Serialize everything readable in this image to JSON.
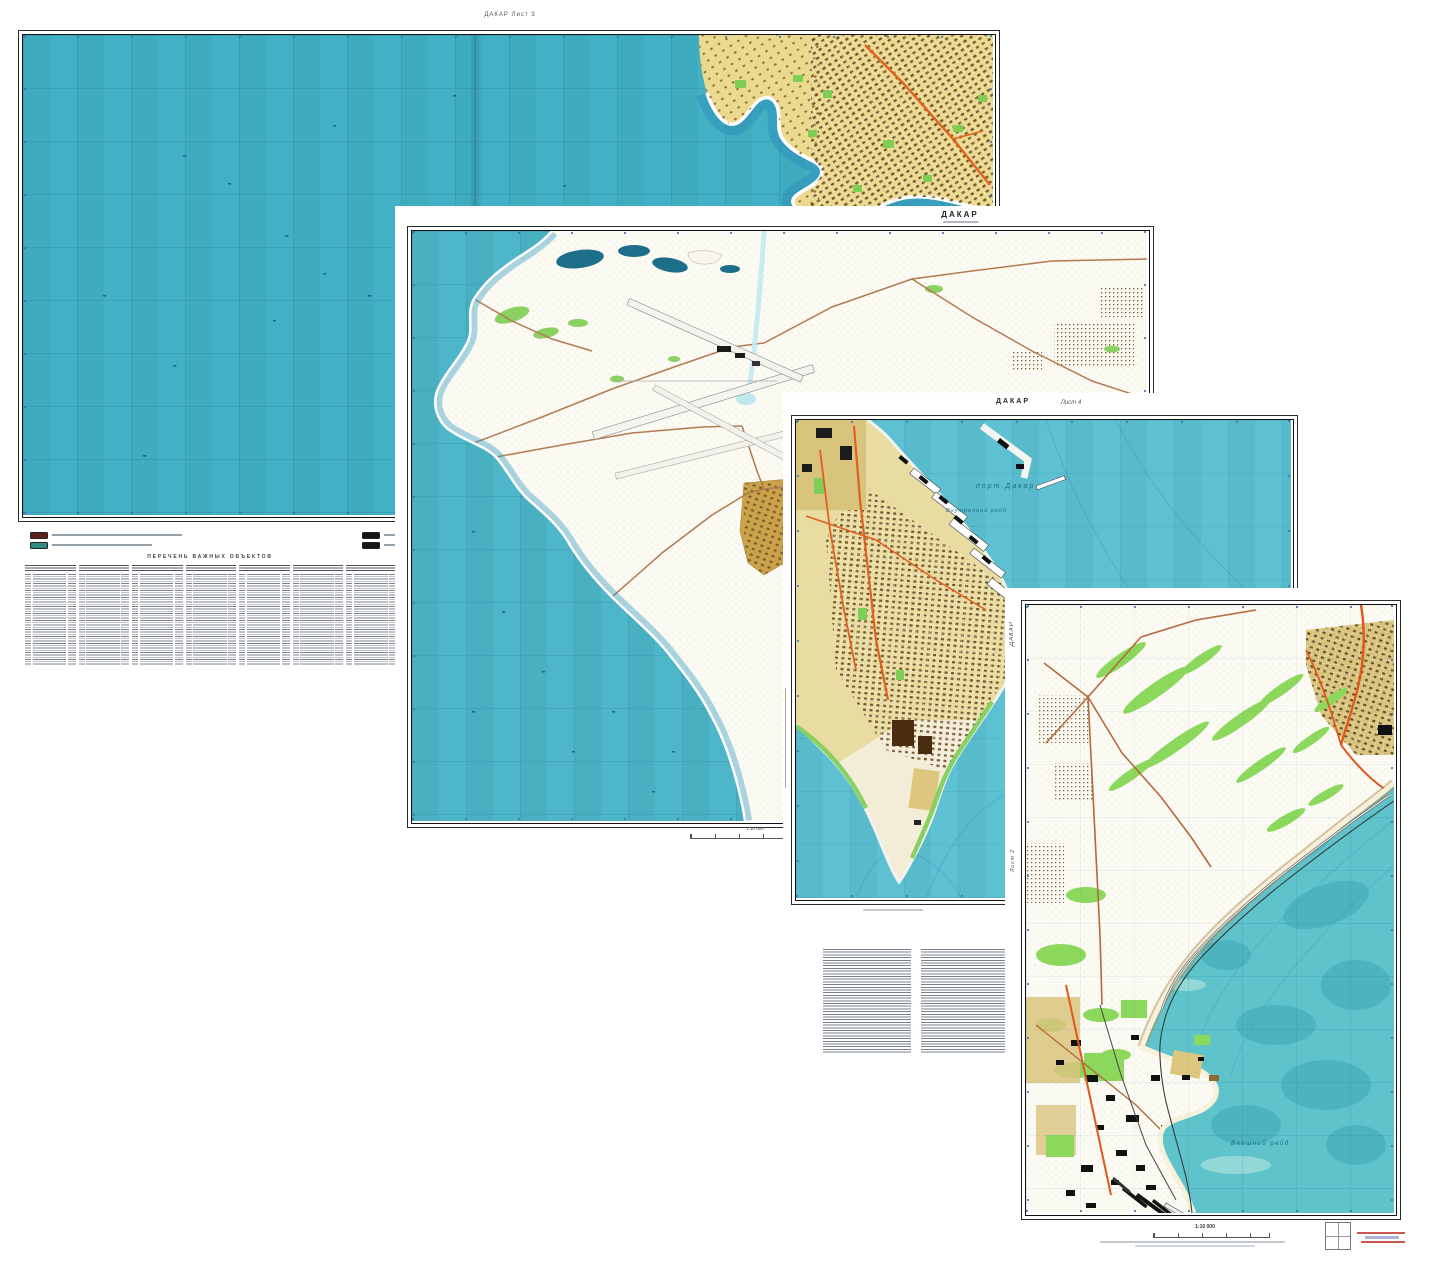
{
  "page": {
    "width": 1445,
    "height": 1265,
    "background": "#ffffff"
  },
  "sheet1": {
    "header_label": "ДАКАР Лист 3",
    "legend_heading": "ПЕРЕЧЕНЬ ВАЖНЫХ ОБЪЕКТОВ",
    "legend": [
      {
        "name": "built-up-quarters",
        "color": "#5f1f1c"
      },
      {
        "name": "water-features",
        "color": "#2e8b86"
      },
      {
        "name": "industrial-objects",
        "color": "#141414"
      },
      {
        "name": "transport-objects",
        "color": "#161616"
      },
      {
        "name": "important-buildings",
        "color": "#c8873c"
      },
      {
        "name": "other-objects",
        "color": "#8a5a26"
      }
    ],
    "index_table_columns": 7
  },
  "sheet2": {
    "title": "ДАКАР",
    "scale_label": "1:10 000"
  },
  "sheet3": {
    "title": "ДАКАР",
    "sheet_label": "Лист 4",
    "water_label_port": "порт Дакар",
    "water_label_road": "Внутренний рейд"
  },
  "sheet4": {
    "side_label": "ДАКАР",
    "side_sheet_label": "Лист 2",
    "scale_label": "1:10 000",
    "water_label": "Внешний рейд"
  },
  "palette": {
    "ocean_sheet1": "#43b1c5",
    "ocean_sheet2": "#4db6c8",
    "ocean_sheet3": "#5ec1d3",
    "ocean_sheet4": "#5fc3cb",
    "land_white": "#fbfaf3",
    "city_tan": "#d9c47e",
    "vegetation_green": "#8bd85c",
    "main_road_orange": "#e0641e",
    "road_brown": "#b5693c",
    "building_dark_brown": "#5f3c16",
    "frame_black": "#1a1a1a",
    "water_label_blue": "#186b85"
  }
}
